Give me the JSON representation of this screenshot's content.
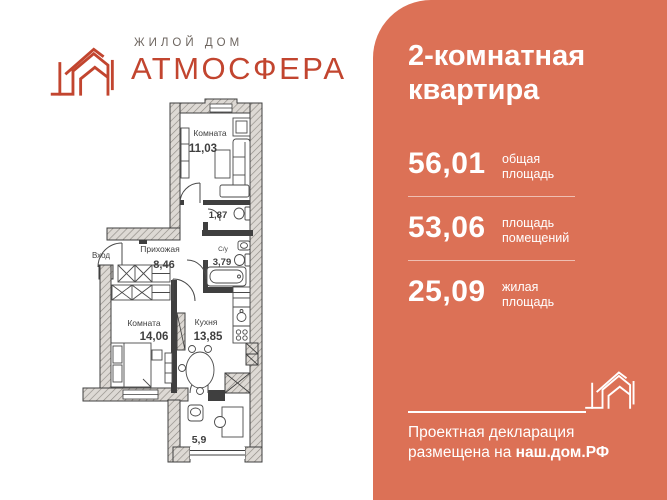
{
  "colors": {
    "panel": "#dc7156",
    "accent": "#c2452f",
    "wall": "#3f3f3f",
    "logo-gray": "#6e6660"
  },
  "logo": {
    "subtitle": "ЖИЛОЙ ДОМ",
    "title": "АТМОСФЕРА"
  },
  "floor_plan": {
    "entrance_label": "Вход",
    "rooms": [
      {
        "name": "Комната",
        "area": "11,03"
      },
      {
        "name": "",
        "area": "1,87"
      },
      {
        "name": "Прихожая",
        "area": "8,46"
      },
      {
        "name": "С/у",
        "area": "3,79"
      },
      {
        "name": "Комната",
        "area": "14,06"
      },
      {
        "name": "Кухня",
        "area": "13,85"
      },
      {
        "name": "",
        "area": "5,9"
      }
    ]
  },
  "panel": {
    "title_lines": [
      "2-комнатная",
      "квартира"
    ],
    "stats": [
      {
        "value": "56,01",
        "label": "общая площадь"
      },
      {
        "value": "53,06",
        "label": "площадь помещений"
      },
      {
        "value": "25,09",
        "label": "жилая площадь"
      }
    ],
    "declaration": {
      "line1": "Проектная декларация",
      "line2_prefix": "размещена на ",
      "link": "наш.дом.РФ"
    }
  }
}
